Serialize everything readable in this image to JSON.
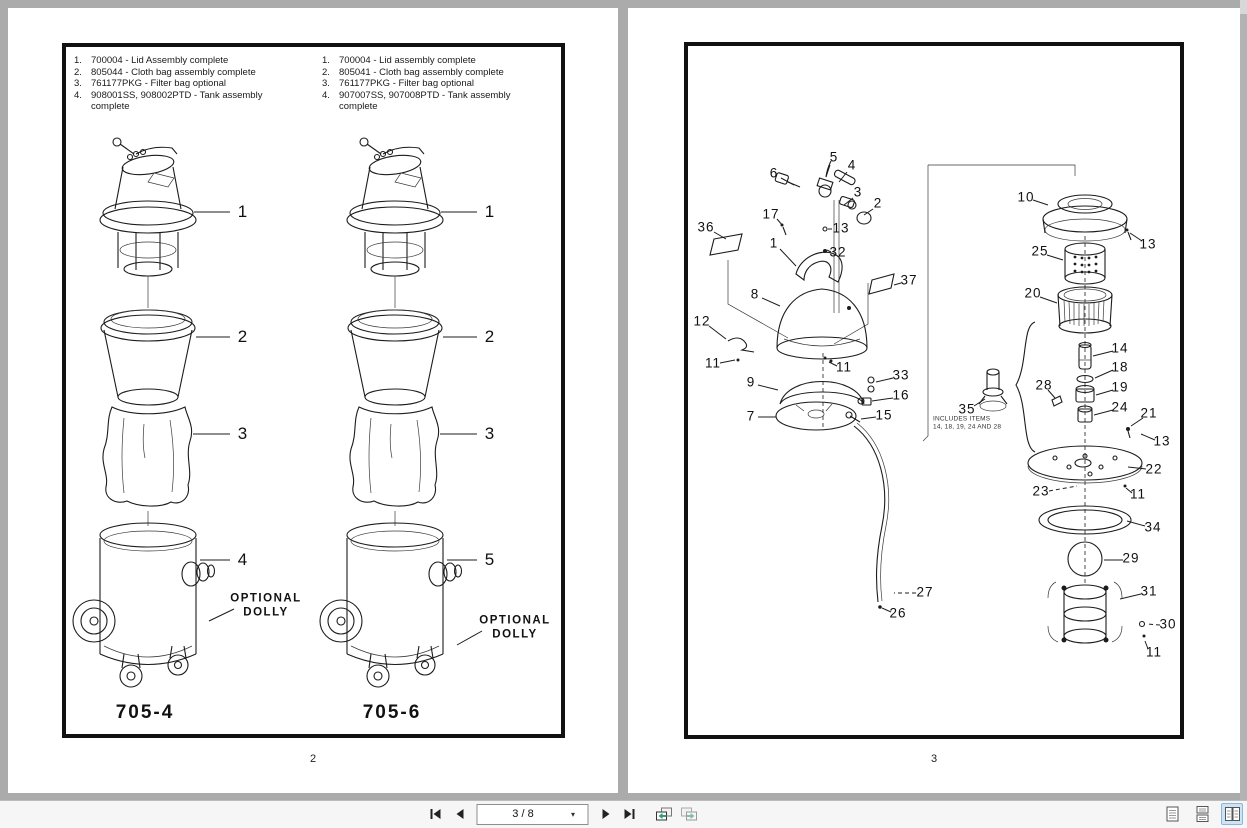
{
  "viewer": {
    "background": "#ababab",
    "page_color": "#ffffff",
    "selected_view_color": "#cfe3f6"
  },
  "toolbar": {
    "page_display": "3 / 8",
    "icons": [
      "first-page",
      "previous-page",
      "page-dropdown",
      "next-page",
      "last-page",
      "previous-view",
      "next-view",
      "single-page-view",
      "continuous-view",
      "facing-pages-view"
    ]
  },
  "page2": {
    "page_number": "2",
    "models": {
      "left": "705-4",
      "right": "705-6"
    },
    "list_left": [
      {
        "num": "1.",
        "text": "700004 - Lid Assembly complete"
      },
      {
        "num": "2.",
        "text": "805044 - Cloth bag assembly complete"
      },
      {
        "num": "3.",
        "text": "761177PKG - Filter bag optional"
      },
      {
        "num": "4.",
        "text": "908001SS, 908002PTD - Tank assembly complete"
      }
    ],
    "list_right": [
      {
        "num": "1.",
        "text": "700004 - Lid assembly complete"
      },
      {
        "num": "2.",
        "text": "805041 - Cloth bag assembly complete"
      },
      {
        "num": "3.",
        "text": "761177PKG - Filter bag optional"
      },
      {
        "num": "4.",
        "text": "907007SS, 907008PTD - Tank assembly complete"
      }
    ],
    "callouts": [
      {
        "t": "1",
        "x": 235,
        "y": 204,
        "line": [
          186,
          204,
          222,
          204
        ]
      },
      {
        "t": "2",
        "x": 235,
        "y": 329,
        "line": [
          188,
          329,
          222,
          329
        ]
      },
      {
        "t": "3",
        "x": 235,
        "y": 426,
        "line": [
          185,
          426,
          222,
          426
        ]
      },
      {
        "t": "4",
        "x": 235,
        "y": 552,
        "line": [
          192,
          552,
          222,
          552
        ]
      },
      {
        "t": "OPTIONAL\nDOLLY",
        "x": 258,
        "y": 598,
        "cls": "dolly",
        "line": [
          201,
          613,
          226,
          601
        ]
      },
      {
        "t": "1",
        "x": 482,
        "y": 204,
        "line": [
          433,
          204,
          469,
          204
        ]
      },
      {
        "t": "2",
        "x": 482,
        "y": 329,
        "line": [
          435,
          329,
          469,
          329
        ]
      },
      {
        "t": "3",
        "x": 482,
        "y": 426,
        "line": [
          432,
          426,
          469,
          426
        ]
      },
      {
        "t": "5",
        "x": 482,
        "y": 552,
        "line": [
          439,
          552,
          469,
          552
        ]
      },
      {
        "t": "OPTIONAL\nDOLLY",
        "x": 507,
        "y": 620,
        "cls": "dolly",
        "line": [
          449,
          637,
          474,
          623
        ]
      }
    ]
  },
  "page3": {
    "page_number": "3",
    "callouts": [
      {
        "t": "5",
        "x": 206,
        "y": 150,
        "line": [
          202,
          157,
          198,
          169
        ]
      },
      {
        "t": "4",
        "x": 224,
        "y": 158,
        "line": [
          219,
          164,
          211,
          174
        ]
      },
      {
        "t": "6",
        "x": 146,
        "y": 166,
        "line": [
          153,
          170,
          166,
          177
        ]
      },
      {
        "t": "3",
        "x": 230,
        "y": 185,
        "line": [
          225,
          190,
          216,
          197
        ]
      },
      {
        "t": "2",
        "x": 250,
        "y": 196,
        "line": [
          245,
          201,
          236,
          207
        ]
      },
      {
        "t": "17",
        "x": 143,
        "y": 207,
        "line": [
          149,
          211,
          155,
          218
        ]
      },
      {
        "t": "13",
        "x": 213,
        "y": 221,
        "dash": true,
        "line": [
          200,
          221,
          206,
          221
        ]
      },
      {
        "t": "36",
        "x": 78,
        "y": 220,
        "line": [
          86,
          224,
          98,
          231
        ]
      },
      {
        "t": "1",
        "x": 146,
        "y": 236,
        "line": [
          152,
          241,
          168,
          258
        ]
      },
      {
        "t": "32",
        "x": 210,
        "y": 245,
        "line": [
          203,
          244,
          199,
          242
        ]
      },
      {
        "t": "8",
        "x": 127,
        "y": 287,
        "line": [
          134,
          290,
          152,
          298
        ]
      },
      {
        "t": "37",
        "x": 281,
        "y": 273,
        "line": [
          273,
          275,
          266,
          277
        ]
      },
      {
        "t": "12",
        "x": 74,
        "y": 314,
        "line": [
          81,
          318,
          98,
          331
        ]
      },
      {
        "t": "11",
        "x": 85,
        "y": 356,
        "line": [
          92,
          355,
          107,
          352
        ]
      },
      {
        "t": "9",
        "x": 123,
        "y": 375,
        "line": [
          130,
          377,
          150,
          382
        ]
      },
      {
        "t": "11",
        "x": 216,
        "y": 360,
        "line": [
          209,
          358,
          201,
          354
        ]
      },
      {
        "t": "33",
        "x": 273,
        "y": 368,
        "line": [
          265,
          370,
          248,
          374
        ]
      },
      {
        "t": "16",
        "x": 273,
        "y": 388,
        "line": [
          265,
          390,
          244,
          393
        ]
      },
      {
        "t": "7",
        "x": 123,
        "y": 409,
        "line": [
          130,
          409,
          148,
          409
        ]
      },
      {
        "t": "15",
        "x": 256,
        "y": 408,
        "line": [
          248,
          409,
          233,
          411
        ]
      },
      {
        "t": "27",
        "x": 297,
        "y": 585,
        "dash": true,
        "line": [
          288,
          585,
          266,
          585
        ]
      },
      {
        "t": "26",
        "x": 270,
        "y": 606,
        "line": [
          263,
          604,
          254,
          600
        ]
      },
      {
        "t": "10",
        "x": 398,
        "y": 190,
        "line": [
          405,
          192,
          420,
          197
        ]
      },
      {
        "t": "13",
        "x": 520,
        "y": 237,
        "line": [
          514,
          233,
          502,
          225
        ]
      },
      {
        "t": "25",
        "x": 412,
        "y": 244,
        "line": [
          419,
          247,
          435,
          252
        ]
      },
      {
        "t": "20",
        "x": 405,
        "y": 286,
        "line": [
          412,
          289,
          429,
          295
        ]
      },
      {
        "t": "14",
        "x": 492,
        "y": 341,
        "line": [
          485,
          343,
          465,
          348
        ]
      },
      {
        "t": "18",
        "x": 492,
        "y": 360,
        "line": [
          485,
          362,
          467,
          370
        ]
      },
      {
        "t": "19",
        "x": 492,
        "y": 380,
        "line": [
          485,
          382,
          468,
          387
        ]
      },
      {
        "t": "24",
        "x": 492,
        "y": 400,
        "line": [
          485,
          402,
          466,
          407
        ]
      },
      {
        "t": "21",
        "x": 521,
        "y": 406,
        "line": [
          515,
          410,
          503,
          418
        ]
      },
      {
        "t": "28",
        "x": 416,
        "y": 378,
        "line": [
          420,
          382,
          427,
          390
        ]
      },
      {
        "t": "35",
        "x": 339,
        "y": 402,
        "line": [
          346,
          398,
          357,
          391
        ]
      },
      {
        "t": "13",
        "x": 534,
        "y": 434,
        "line": [
          527,
          432,
          513,
          426
        ]
      },
      {
        "t": "22",
        "x": 526,
        "y": 462,
        "line": [
          518,
          461,
          500,
          459
        ]
      },
      {
        "t": "23",
        "x": 413,
        "y": 484,
        "dash": true,
        "line": [
          421,
          483,
          449,
          478
        ]
      },
      {
        "t": "11",
        "x": 510,
        "y": 487,
        "line": [
          504,
          485,
          498,
          480
        ]
      },
      {
        "t": "34",
        "x": 525,
        "y": 520,
        "line": [
          517,
          518,
          499,
          513
        ]
      },
      {
        "t": "29",
        "x": 503,
        "y": 551,
        "line": [
          495,
          552,
          476,
          552
        ]
      },
      {
        "t": "31",
        "x": 521,
        "y": 584,
        "line": [
          513,
          586,
          492,
          591
        ]
      },
      {
        "t": "30",
        "x": 540,
        "y": 617,
        "dash": true,
        "line": [
          532,
          617,
          519,
          616
        ]
      },
      {
        "t": "11",
        "x": 526,
        "y": 645,
        "line": [
          520,
          641,
          517,
          633
        ]
      },
      {
        "t": "INCLUDES ITEMS\n14, 18, 19, 24 AND 28",
        "x": 305,
        "y": 416,
        "cls": "note"
      }
    ]
  }
}
